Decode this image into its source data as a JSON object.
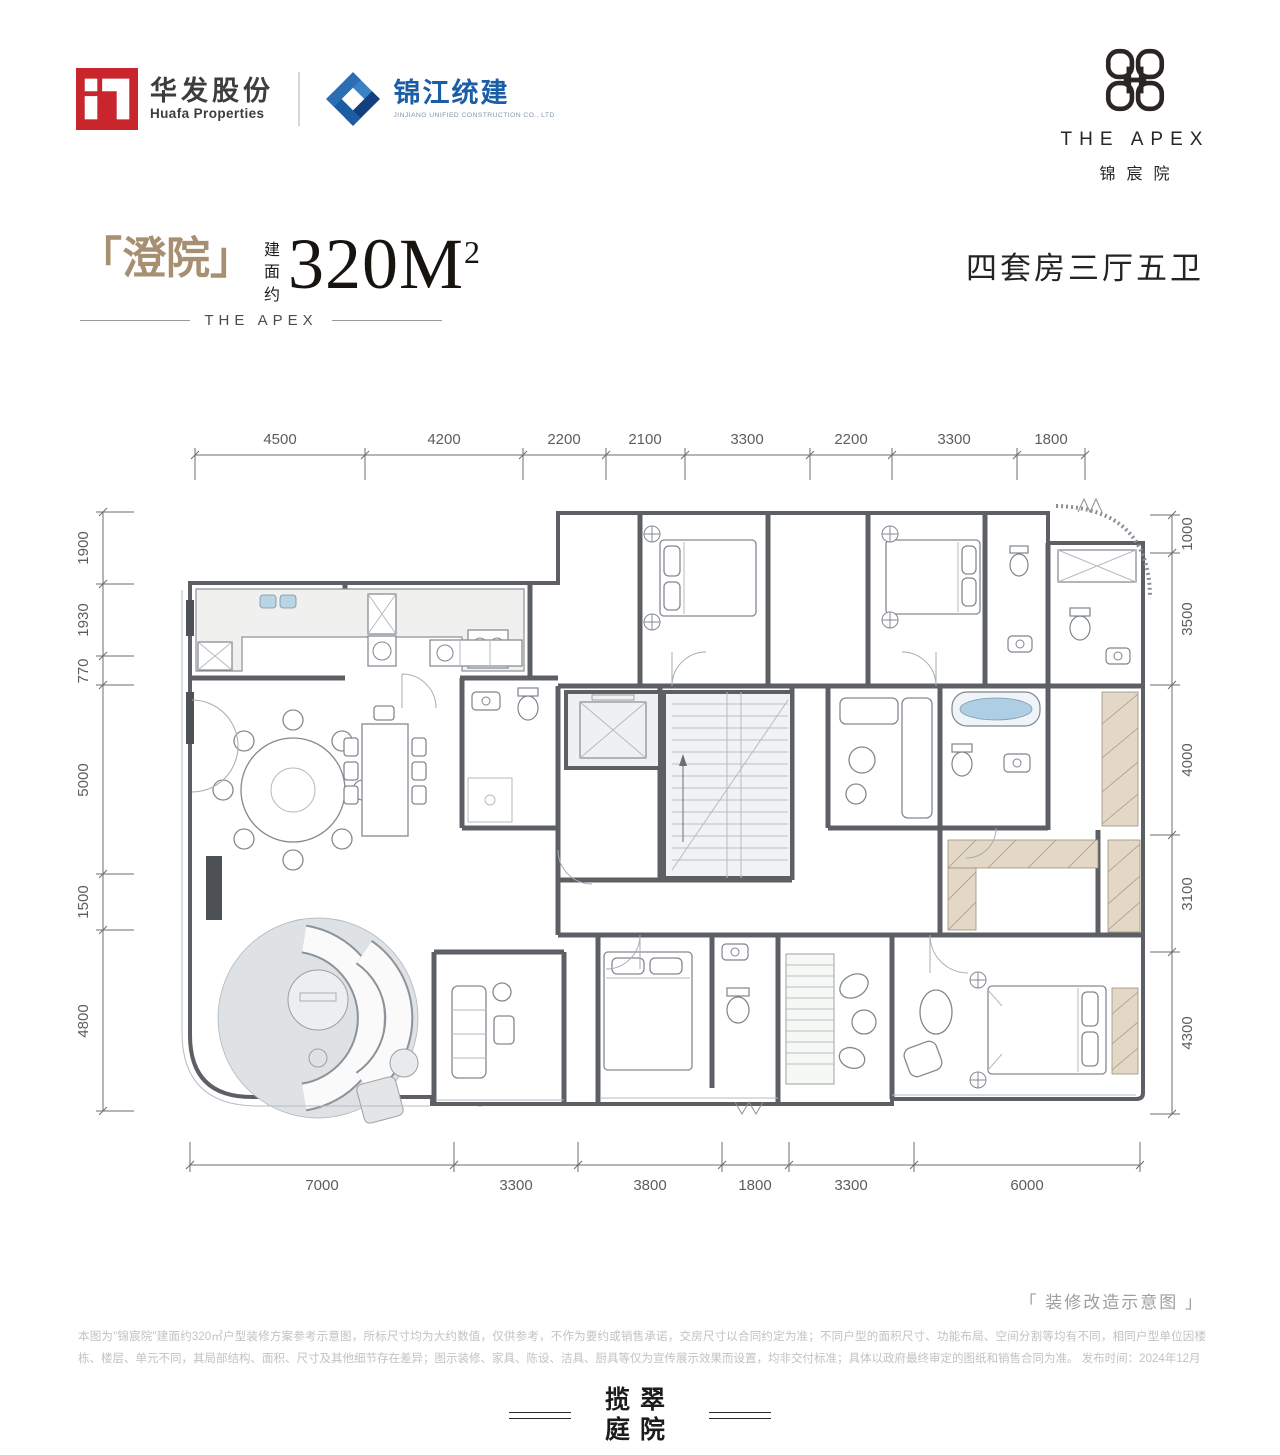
{
  "header": {
    "huafa": {
      "name_cn": "华发股份",
      "name_en": "Huafa Properties"
    },
    "jinjiang": {
      "name_cn": "锦江统建",
      "name_en": "JINJIANG UNIFIED CONSTRUCTION CO., LTD"
    },
    "apex": {
      "name_en": "THE APEX",
      "name_cn": "锦宸院"
    }
  },
  "title": {
    "unit_name": "「澄院」",
    "area_label_chars": [
      "建",
      "面",
      "约"
    ],
    "area_value": "320M",
    "area_sup": "2",
    "brand": "THE APEX",
    "spec": "四套房三厅五卫"
  },
  "plan": {
    "dims_top": [
      "4500",
      "4200",
      "2200",
      "2100",
      "3300",
      "2200",
      "3300",
      "1800"
    ],
    "dims_left": [
      "1900",
      "1930",
      "770",
      "5000",
      "1500",
      "4800"
    ],
    "dims_right": [
      "1000",
      "3500",
      "4000",
      "3100",
      "4300"
    ],
    "dims_bottom": [
      "7000",
      "3300",
      "3800",
      "1800",
      "3300",
      "6000"
    ]
  },
  "caption": "「 装修改造示意图 」",
  "disclaimer": "本图为\"锦宸院\"建面约320㎡户型装修方案参考示意图，所标尺寸均为大约数值，仅供参考，不作为要约或销售承诺，交房尺寸以合同约定为准；不同户型的面积尺寸、功能布局、空间分割等均有不同，相同户型单位因楼栋、楼层、单元不同，其局部结构、面积、尺寸及其他细节存在差异；图示装修、家具、陈设、洁具、厨具等仅为宣传展示效果而设置，均非交付标准；具体以政府最终审定的图纸和销售合同为准。 发布时间：2024年12月",
  "footer": {
    "logo_line1": "揽翠",
    "logo_line2": "庭院"
  },
  "colors": {
    "huafa_red": "#c8252c",
    "jinjiang_blue": "#1b5ea6",
    "title_gold": "#a79071",
    "green_area": "#dbe9d3",
    "wall_gray": "#5c6064",
    "tub_blue": "#aecfe3"
  }
}
